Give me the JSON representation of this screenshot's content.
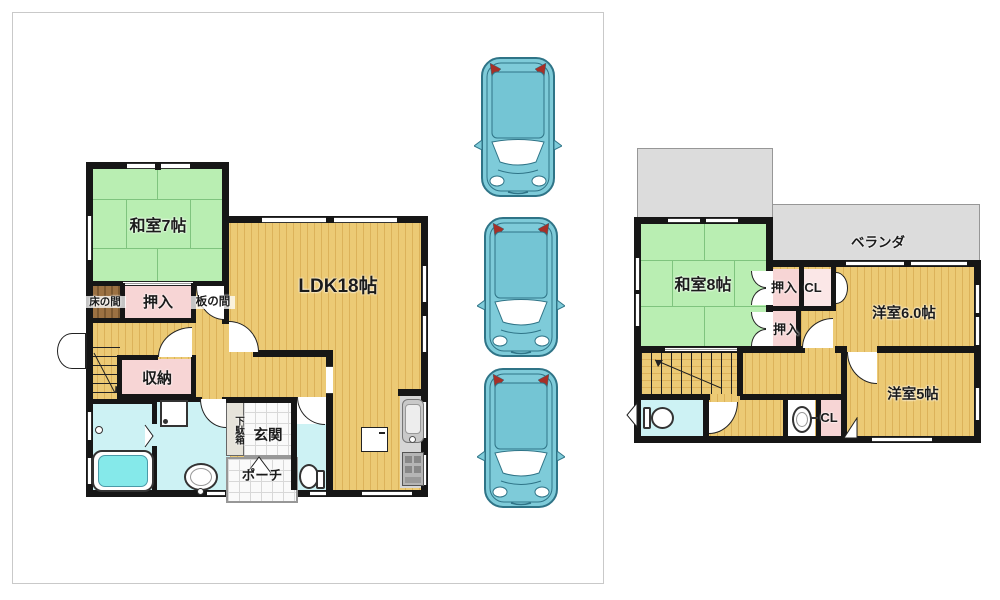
{
  "floor1": {
    "washitsu_label": "和室7帖",
    "ldk_label": "LDK18帖",
    "tokonoma_label": "床の間",
    "oshiire_label": "押入",
    "itanoma_label": "板の間",
    "shuno_label": "収納",
    "getabako_label": "下駄箱",
    "genkan_label": "玄関",
    "porch_label": "ポーチ"
  },
  "floor2": {
    "veranda_label": "ベランダ",
    "washitsu_label": "和室8帖",
    "oshiire_upper_label": "押入",
    "closet_upper_label": "CL",
    "oshiire_lower_label": "押入",
    "western6_label": "洋室6.0帖",
    "western5_label": "洋室5帖",
    "closet_lower_label": "CL"
  },
  "parking": {
    "car_count": 3
  },
  "colors": {
    "wall": "#161616",
    "tatami": "#b9eeb2",
    "tatami_line": "#7fc47e",
    "floor": "#ecca75",
    "floor_stripe": "#dcb25a",
    "pink": "#f7d5d5",
    "pink_light": "#fbe7e7",
    "brown": "#9c7142",
    "brown_stripe": "#7c5830",
    "cyan": "#cdf2f4",
    "tub": "#85e9ea",
    "gray_area": "#dcdcdc",
    "gray_border": "#979797",
    "tile_line": "#d8d8d8",
    "counter": "#d6d6d6",
    "car_body": "#7ecbd9",
    "car_line": "#2f7487",
    "car_red": "#a63028",
    "box_border": "#c9c9c9",
    "text": "#1b1b1b"
  }
}
